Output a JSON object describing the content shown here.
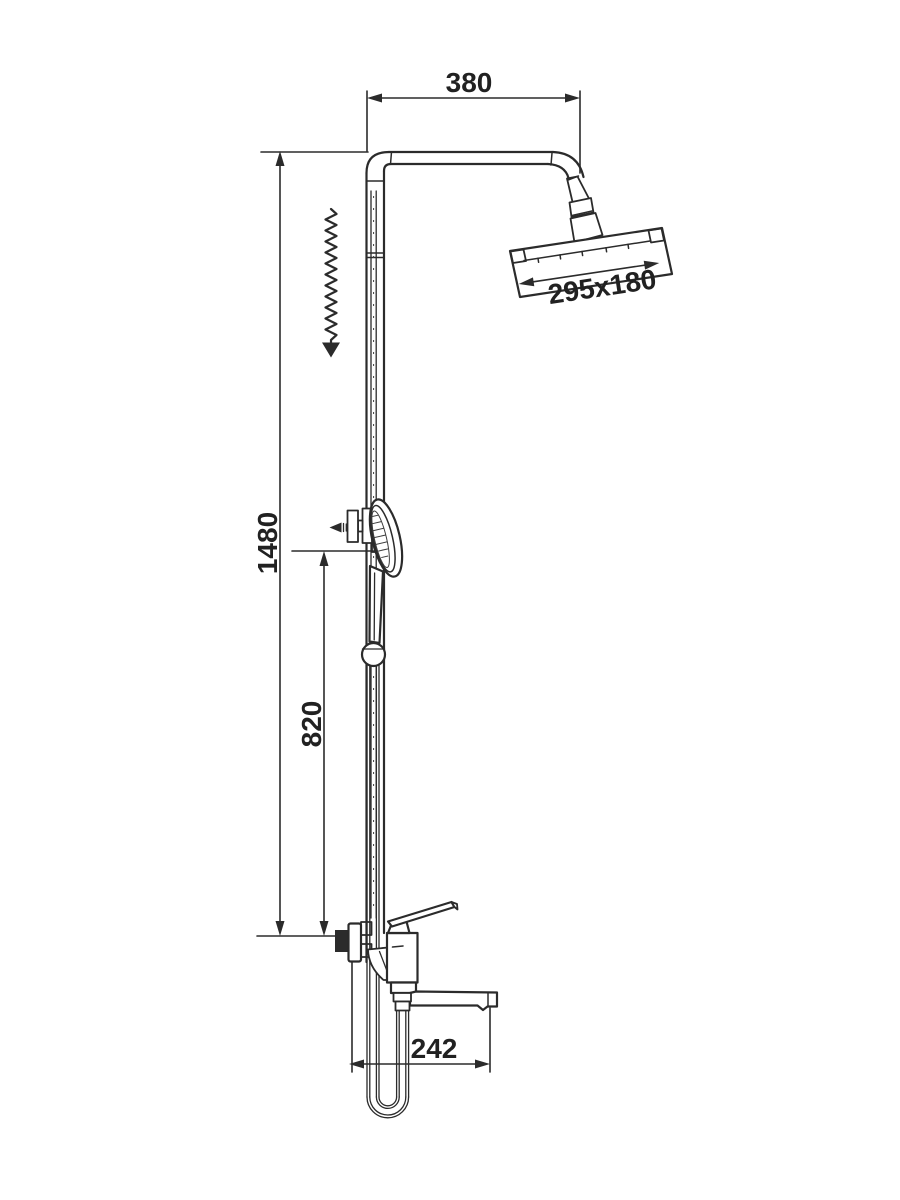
{
  "drawing": {
    "kind": "shower-system-installation-diagram",
    "background": "#ffffff",
    "line_color": "#2b2b2b",
    "text_color": "#212121",
    "labels": {
      "arm_width": "380",
      "head_size": "295x180",
      "total_height": "1480",
      "handshower_height": "820",
      "spout_reach": "242"
    }
  }
}
